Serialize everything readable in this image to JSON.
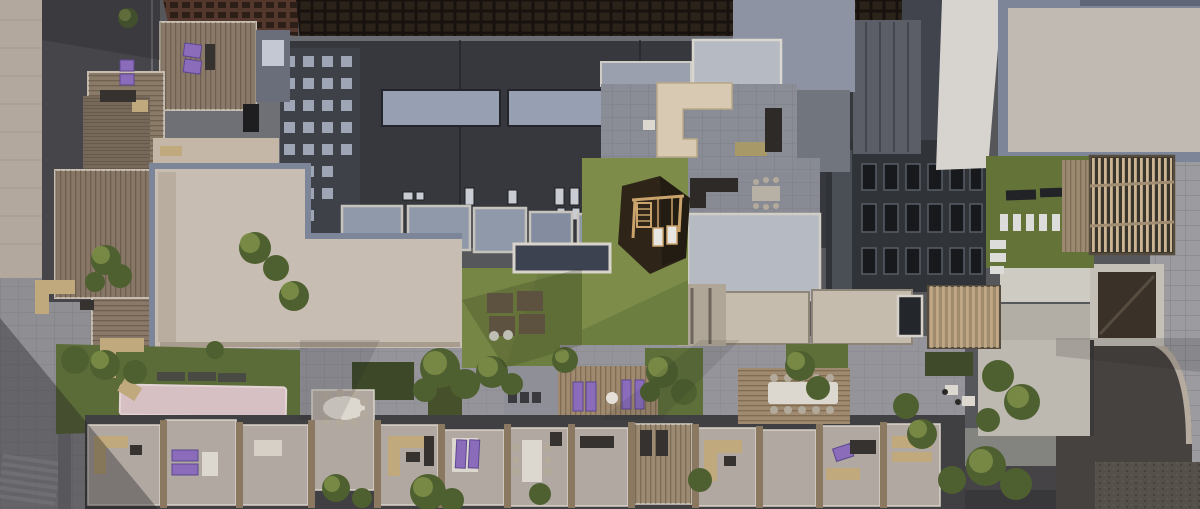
{
  "image": {
    "width": 1200,
    "height": 509
  },
  "scene": {
    "description": "Aerial top-down architectural rendering of a rooftop courtyard complex: wooden terrace decks with purple and tan outdoor furniture, central green lawn with dark hexagonal play pad and wooden swing set, beige and blue-gray flat roofs, dark building facades with window grids, right-side roof lawn with white paver stripes and wooden pergola, streets and sidewalks on the outer edges, scattered trees.",
    "areas": {
      "left_street": "sidewalk and alley with stairs",
      "top_left_terraces": "stacked balconies with wood decking and purple loungers",
      "top_buildings": "dark facades with waffle-grid roof and window bands",
      "center_lawn": "green amenity lawn with swing pad, seat pads and loungers deck",
      "big_beige_roof": "large light flat roof with blue-gray edge frame",
      "right_roof_lawn": "green roof with white stripe pavers and benches",
      "pergola": "slatted wood pergola",
      "bottom_terraces": "row of private terraces with dining sets, sofas and loungers",
      "right_street": "asphalt street with curved curb, cobbles and sidewalk"
    }
  },
  "palette": {
    "base": "#56575b",
    "wall_beige": "#b3a89d",
    "alley_dark": "#46464a",
    "pavement": "#8e8e93",
    "pavement_mid": "#94949a",
    "street_dark": "#454346",
    "street_right": "#46423f",
    "sidewalk": "#9c9ca0",
    "cobble": "#555049",
    "curb": "#b5ab9f",
    "roof_waffle": "#251e18",
    "roof_rust": "#5f3d32",
    "facade_dark": "#36383d",
    "facade_darker": "#303338",
    "facade_window_bldg": "#3e4148",
    "window_light": "#97a0b2",
    "window_dark": "#17191d",
    "roof_bluegray": "#9099aa",
    "roof_light": "#b6bac2",
    "roof_pale": "#cecbc3",
    "roof_beige": "#c8bdb2",
    "roof_frame": "#7d8698",
    "roof_tan_big": "#c0bab2",
    "wall_white": "#d7d4d0",
    "columns_dark": "#5b5e66",
    "atrium_glass": "#3a3128",
    "lawn": "#6d7e41",
    "lawn_light": "#8d9c52",
    "lawn_dark": "#5c6c39",
    "lawn_right": "#647439",
    "hedge": "#3d4829",
    "deck_wood": "#8a7969",
    "deck_warm": "#a08a6f",
    "pergola_underlay": "#3a352c",
    "hex_dark": "#2e2418",
    "swing_wood": "#caa36c",
    "terrace_stone": "#b0a8a1",
    "divider_wood": "#8a7860",
    "furniture_purple": "#8a6cba",
    "furniture_tan": "#c0a97d",
    "furniture_white": "#ddd8cf",
    "furniture_dark": "#35322f",
    "bocce_pink": "#d6c0c4",
    "stripe_white": "#dcdcda",
    "tree_dark": "#4f6030",
    "tree_mid": "#66783a",
    "tree_light": "#7e9048",
    "shadow": "#1a1a1e"
  }
}
